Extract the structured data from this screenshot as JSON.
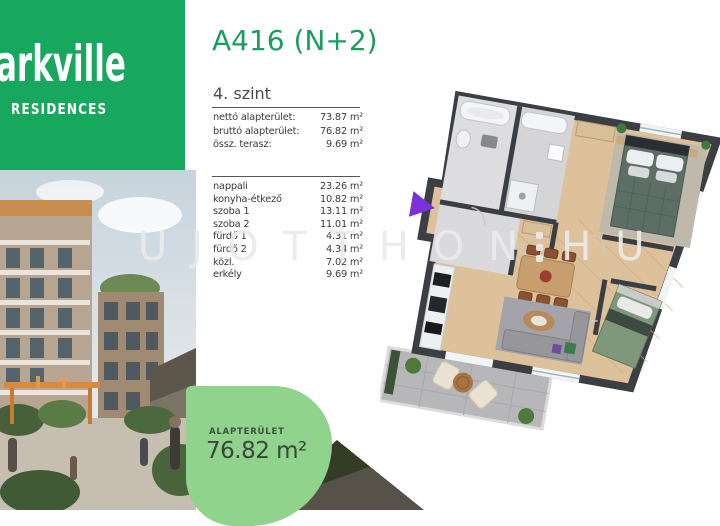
{
  "brand": {
    "name_visible": "arkville",
    "subtitle": "RESIDENCES"
  },
  "header": {
    "title": "A416 (N+2)",
    "floor_label": "4. szint"
  },
  "summary_table": {
    "rows": [
      {
        "label": "nettó alapterület:",
        "value": "73.87 m²"
      },
      {
        "label": "bruttó alapterület:",
        "value": "76.82 m²"
      },
      {
        "label": "össz. terasz:",
        "value": "9.69 m²"
      }
    ]
  },
  "room_table": {
    "rows": [
      {
        "label": "nappali",
        "value": "23.26 m²"
      },
      {
        "label": "konyha-étkező",
        "value": "10.82 m²"
      },
      {
        "label": "szoba 1",
        "value": "13.11 m²"
      },
      {
        "label": "szoba 2",
        "value": "11.01 m²"
      },
      {
        "label": "fürdő 1",
        "value": "4.31 m²"
      },
      {
        "label": "fürdő 2",
        "value": "4.34 m²"
      },
      {
        "label": "közl.",
        "value": "7.02 m²"
      },
      {
        "label": "erkély",
        "value": "9.69 m²"
      }
    ]
  },
  "area_badge": {
    "label": "ALAPTERÜLET",
    "value": "76.82 m²"
  },
  "watermark": {
    "text_left": "UJOTTHON",
    "text_right": "HU"
  },
  "floorplan": {
    "description": "3D top-down floor plan of apartment A416 with two bathrooms, two bedrooms, living-dining area, kitchen and balcony",
    "entrance_marker": "purple-arrow"
  },
  "colors": {
    "brand_green": "#18a85d",
    "title_green": "#18a05a",
    "badge_green": "#8fd38c",
    "wall_dark": "#3b3f44",
    "wood_floor": "#dcc19b"
  }
}
